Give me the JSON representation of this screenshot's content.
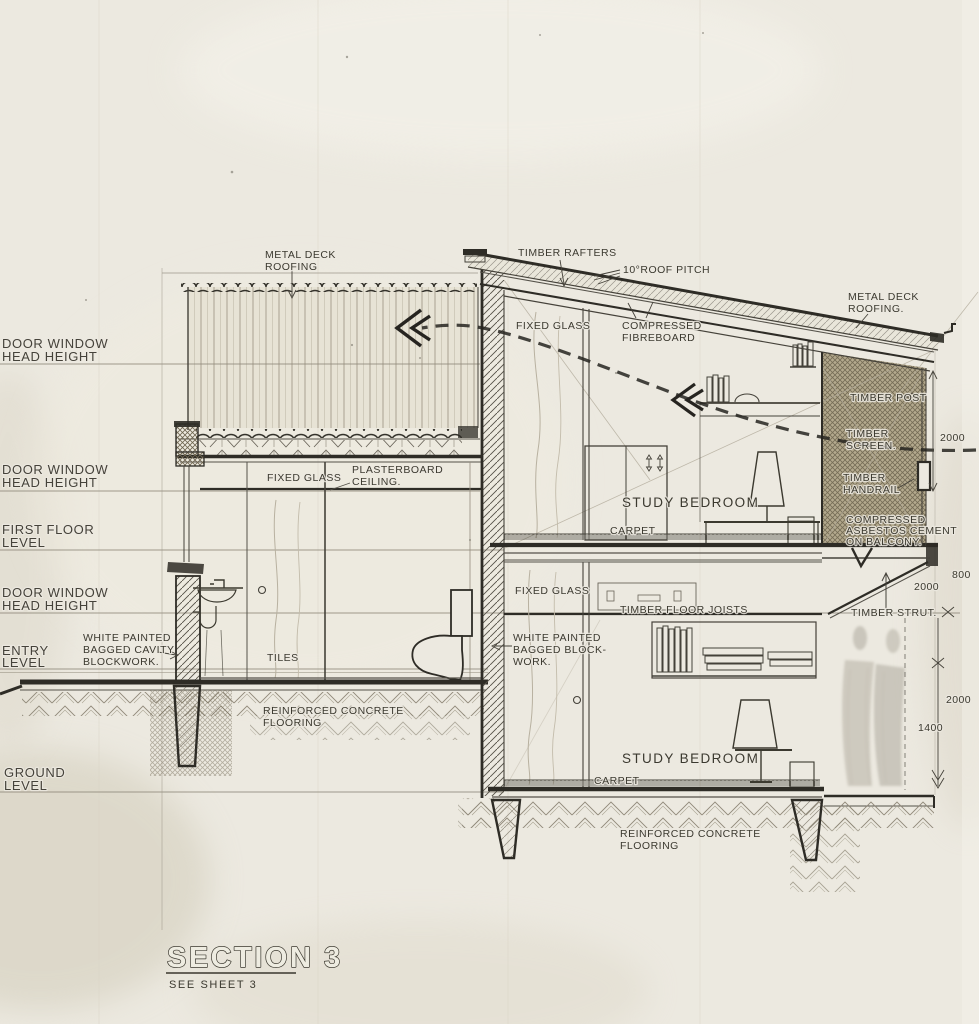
{
  "drawing_type": "architectural building section",
  "title_block": {
    "title": "SECTION 3",
    "subtitle": "SEE SHEET 3"
  },
  "levels": [
    {
      "l1": "DOOR WINDOW",
      "l2": "HEAD HEIGHT"
    },
    {
      "l1": "DOOR WINDOW",
      "l2": "HEAD HEIGHT"
    },
    {
      "l1": "FIRST FLOOR",
      "l2": "LEVEL"
    },
    {
      "l1": "DOOR WINDOW",
      "l2": "HEAD HEIGHT"
    },
    {
      "l1": "ENTRY",
      "l2": "LEVEL"
    },
    {
      "l1": "GROUND",
      "l2": "LEVEL"
    }
  ],
  "roof": {
    "metal_deck_left_1": "METAL DECK",
    "metal_deck_left_2": "ROOFING",
    "timber_rafters": "TIMBER RAFTERS",
    "pitch": "10°ROOF PITCH",
    "metal_deck_right_1": "METAL DECK",
    "metal_deck_right_2": "ROOFING."
  },
  "left_wing": {
    "fixed_glass": "FIXED GLASS",
    "plasterboard_1": "PLASTERBOARD",
    "plasterboard_2": "CEILING.",
    "tiles": "TILES",
    "cavity_1": "WHITE PAINTED",
    "cavity_2": "BAGGED CAVITY",
    "cavity_3": "BLOCKWORK.",
    "rc_1": "REINFORCED CONCRETE",
    "rc_2": "FLOORING"
  },
  "upper_room": {
    "fixed_glass": "FIXED GLASS",
    "fibreboard_1": "COMPRESSED",
    "fibreboard_2": "FIBREBOARD",
    "room": "STUDY BEDROOM",
    "carpet": "CARPET"
  },
  "balcony": {
    "timber_post": "TIMBER POST",
    "screen_1": "TIMBER",
    "screen_2": "SCREEN.",
    "handrail_1": "TIMBER",
    "handrail_2": "HANDRAIL",
    "asbestos_1": "COMPRESSED",
    "asbestos_2": "ASBESTOS CEMENT",
    "asbestos_3": "ON BALCONY.",
    "strut": "TIMBER STRUT."
  },
  "lower_room": {
    "fixed_glass": "FIXED GLASS",
    "joists": "TIMBER FLOOR JOISTS",
    "block_1": "WHITE PAINTED",
    "block_2": "BAGGED BLOCK-",
    "block_3": "WORK.",
    "room": "STUDY BEDROOM",
    "carpet": "CARPET",
    "rc_1": "REINFORCED CONCRETE",
    "rc_2": "FLOORING"
  },
  "dimensions": {
    "upper": "2000",
    "mid_800": "800",
    "mid_2000": "2000",
    "lower_2000": "2000",
    "lower_1400": "1400"
  },
  "colors": {
    "paper": "#ece9e0",
    "ink": "#2e2c26",
    "light_line": "#938c7c",
    "screen_tan": "#b3a98d"
  }
}
